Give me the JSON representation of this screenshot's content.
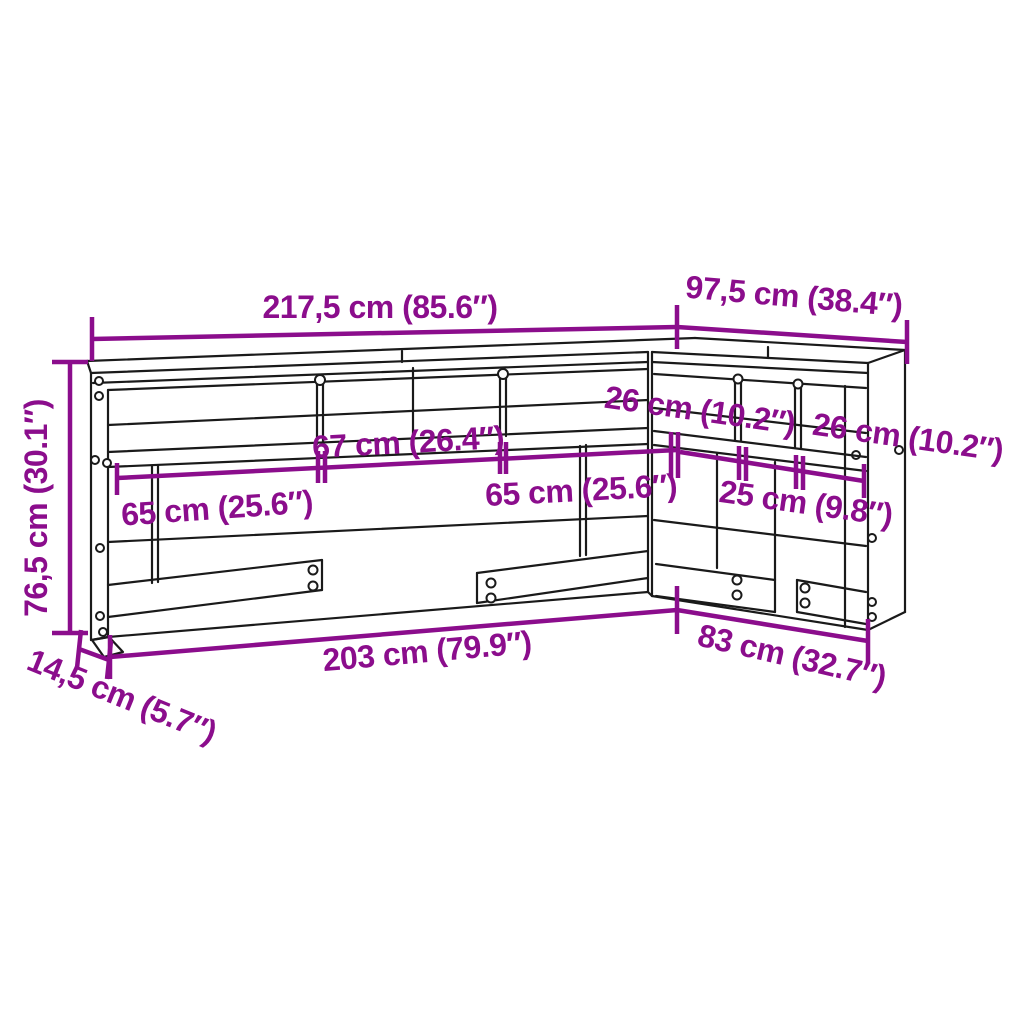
{
  "diagram": {
    "subject": "l-shaped-bookcase-headboard-dimension-drawing",
    "colors": {
      "dimension_annotation": "#8B0D8C",
      "drawing_line": "#1A1A1A",
      "background": "#FFFFFF"
    },
    "dims": {
      "overall_width": "217,5 cm (85.6″)",
      "side_width": "97,5 cm (38.4″)",
      "height": "76,5 cm (30.1″)",
      "depth": "14,5 cm (5.7″)",
      "inner_width": "203 cm (79.9″)",
      "side_inner_width": "83 cm (32.7″)",
      "center_opening_width": "67 cm (26.4″)",
      "left_opening_width": "65 cm (25.6″)",
      "right_opening_width": "65 cm (25.6″)",
      "side_opening_near": "26 cm (10.2″)",
      "side_opening_far": "26 cm (10.2″)",
      "side_opening_center": "25 cm (9.8″)"
    }
  }
}
